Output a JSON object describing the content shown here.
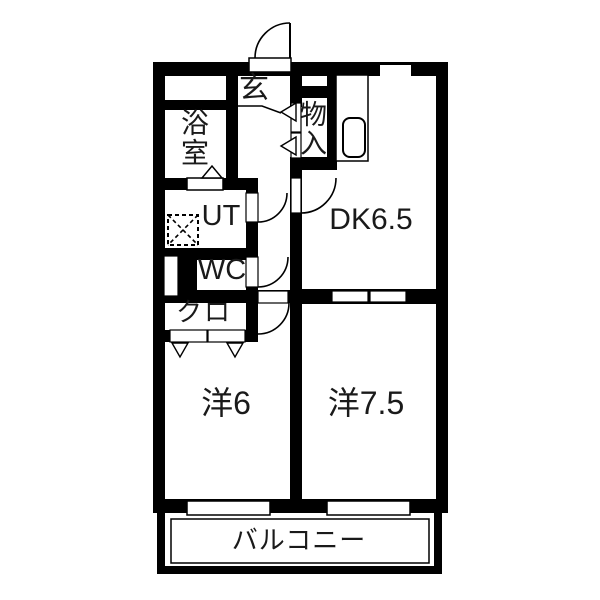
{
  "floorplan": {
    "labels": {
      "genkan": "玄",
      "bath": "浴室",
      "utility": "UT",
      "toilet": "WC",
      "closet": "クロ",
      "storage": "物入",
      "dining_kitchen": "DK6.5",
      "western_room_6": "洋6",
      "western_room_7_5": "洋7.5",
      "balcony": "バルコニー"
    },
    "colors": {
      "wall": "#000000",
      "background": "#ffffff",
      "text": "#1a1a1a"
    }
  }
}
